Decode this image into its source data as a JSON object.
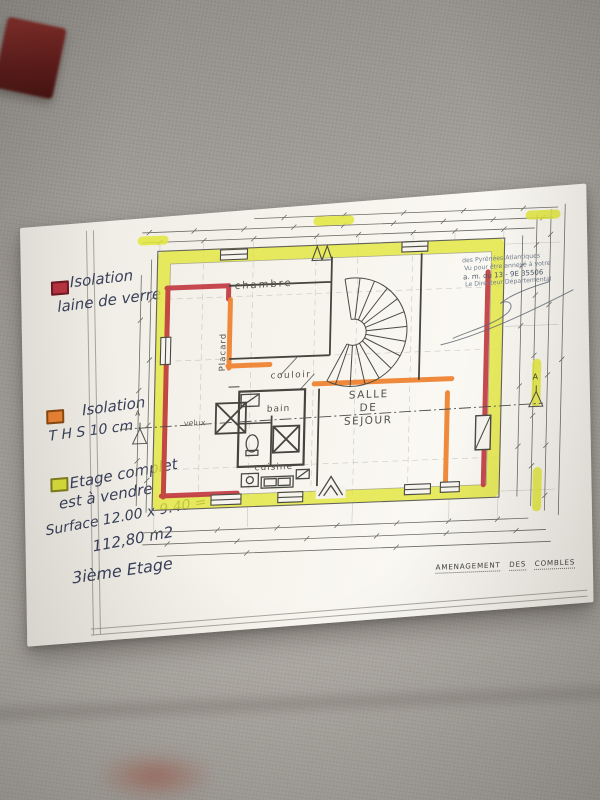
{
  "scene": {
    "background_color": "#a7a39d",
    "paper_color": "#f6f3ec"
  },
  "legend": {
    "items": [
      {
        "swatch_color": "#bb3340",
        "lines": [
          "Isolation",
          "laine de verre"
        ]
      },
      {
        "swatch_color": "#ee8433",
        "lines": [
          "Isolation",
          "T H S  10 cm ."
        ]
      },
      {
        "swatch_color": "#dce23a",
        "lines": [
          "Etage complet",
          "est à vendre",
          "Surface 12.00 x 9.40 =",
          "112,80 m2"
        ]
      }
    ],
    "floor_note": "3ième Etage"
  },
  "plan": {
    "labels": {
      "chambre": "chambre",
      "placard": "Placard",
      "couloir": "couloir",
      "bain": "bain",
      "velux": "velux",
      "cuisine": "cuisine",
      "sejour": [
        "SALLE",
        "DE",
        "SEJOUR"
      ]
    },
    "section_marker": "A",
    "highlights": {
      "exterior_yellow": "#e2e63a",
      "insulation_red": "#c13a40",
      "insulation_orange": "#ee8433"
    }
  },
  "stamp": {
    "lines": [
      "des Pyrénées Atlantiques",
      "Vu pour être annexé à votre",
      "a. m. du 13 - 9E 35506",
      "Le Directeur Départemental"
    ]
  },
  "title_block": {
    "words": [
      "AMENAGEMENT",
      "DES",
      "COMBLES"
    ]
  }
}
